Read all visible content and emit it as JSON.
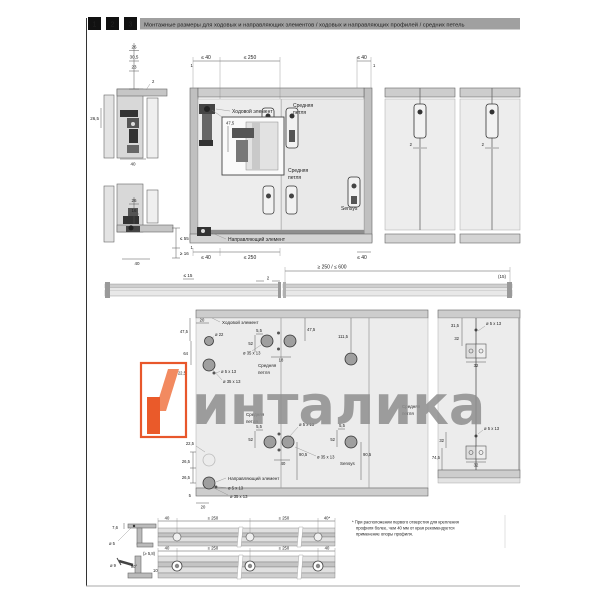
{
  "header": {
    "tabs": [
      "1",
      "2",
      "3"
    ],
    "title": "Монтажные размеры для ходовых и направляющих элементов / ходовых и направляющих профилей / средних петель"
  },
  "colors": {
    "accent_orange": "#ea5a2a",
    "accent_orange_light": "#f28a60",
    "watermark_gray": "#8f8f8f",
    "rail_gray": "#cdcdcd",
    "panel_gray": "#ececec"
  },
  "side_top": {
    "d1": "26",
    "d2": "30,5",
    "d3": "23",
    "d4": "26,5",
    "d5": "40",
    "d6": "2"
  },
  "side_bottom": {
    "d1": "26",
    "d2": "16",
    "d3": "≤ 55",
    "d4": "≥ 16",
    "d5": "40"
  },
  "elevation": {
    "top_dims": [
      "≤ 40",
      "≤ 250",
      "≤ 40"
    ],
    "bottom_dims": [
      "≤ 40",
      "≤ 250",
      "≤ 40"
    ],
    "tick": "1",
    "inset_dim": "47,5",
    "runner_label": "Ходовой элемент",
    "hinge_label_1": "Средняя",
    "hinge_label_2": "петля",
    "sensys": "Sensys",
    "guide_label": "Направляющий элемент",
    "panel_gap": "2"
  },
  "strip": {
    "left": "≤ 15",
    "gap": "2",
    "span": "≥ 250 / ≤ 600",
    "right": "(15)"
  },
  "drill": {
    "d20": "20",
    "runner": "Ходовой элемент",
    "d475_left": "47,5",
    "dia22": "ø 22",
    "d64": "64",
    "d225_top": "22,5",
    "dia5_a": "ø 5 x 13",
    "dia35_a": "ø 35 x 13",
    "d55a": "5,5",
    "d52a": "52",
    "dia35_pair": "ø 35 x 13",
    "d18": "18",
    "hinge1a": "Средняя",
    "hinge1b": "петля",
    "d475_mid": "47,5",
    "d1115": "111,5",
    "hinge2a": "Средняя",
    "hinge2b": "петля",
    "d55b": "5,5",
    "d52b": "52",
    "dia5_b": "ø 5 x 13",
    "d905a": "90,5",
    "d40": "40",
    "dia35_b": "ø 35 x 13",
    "d55c": "5,5",
    "d52c": "52",
    "d905b": "90,5",
    "sensys": "Sensys",
    "d225": "22,5",
    "d265a": "26,5",
    "d265b": "26,5",
    "guide": "Направляющий элемент",
    "dia5_c": "ø 5 x 13",
    "dia35_c": "ø 35 x 13",
    "d5": "5",
    "d20b": "20"
  },
  "rightcols": {
    "top": {
      "d315": "31,5",
      "d32a": "32",
      "dia5": "ø 5 x 13",
      "d32b": "32"
    },
    "bottom": {
      "d32a": "32",
      "d745": "74,5",
      "dia5": "ø 5 x 13",
      "d32b": "32",
      "hinge1": "Средняя",
      "hinge2": "петля"
    }
  },
  "profiles": {
    "rowA": {
      "d76": "7,6",
      "dia5": "ø 5",
      "dims": [
        "40",
        "≤ 250",
        "≤ 250",
        "40*"
      ]
    },
    "rowB": {
      "d58": "(≥ 5,8)",
      "dia9": "ø 9",
      "ang": "90°",
      "d10": "10",
      "dims": [
        "40",
        "≤ 250",
        "≤ 250",
        "40"
      ]
    }
  },
  "footnote": {
    "line1": "* При расположении первого отверстия для крепления",
    "line2": "профиля более, чем 40 мм от края рекомендуется",
    "line3": "применение опоры профиля."
  },
  "watermark": {
    "text": "инталика"
  }
}
